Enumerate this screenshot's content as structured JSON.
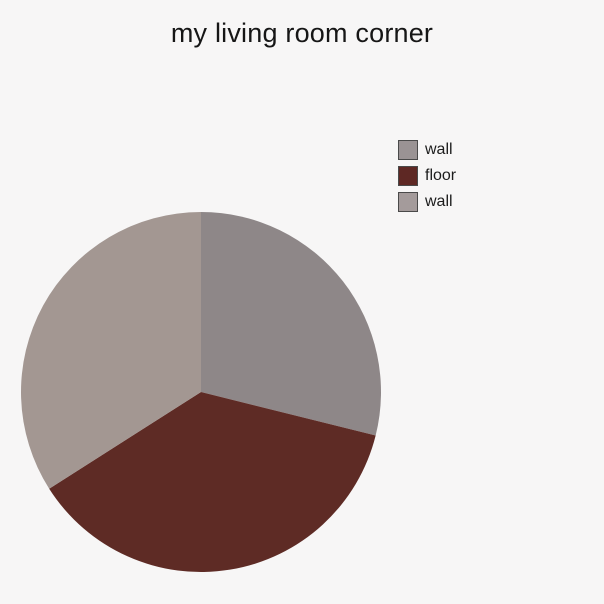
{
  "page": {
    "background_color": "#f7f6f6"
  },
  "title": {
    "text": "my living room corner",
    "color": "#161616"
  },
  "chart_data": {
    "type": "pie",
    "title": "my living room corner",
    "angle_convention": "degrees clockwise from 12 o'clock",
    "center": [
      201,
      392
    ],
    "radius": 180,
    "slices": [
      {
        "label": "wall",
        "start_deg": 0,
        "end_deg": 104,
        "angle_deg": 104,
        "percent": 28.9,
        "color": "#8e8788"
      },
      {
        "label": "floor",
        "start_deg": 104,
        "end_deg": 237.5,
        "angle_deg": 133.5,
        "percent": 37.1,
        "color": "#5e2b25"
      },
      {
        "label": "wall",
        "start_deg": 237.5,
        "end_deg": 360,
        "angle_deg": 122.5,
        "percent": 34.0,
        "color": "#a39792"
      }
    ],
    "legend": {
      "position": "right",
      "entries": [
        {
          "label": "wall",
          "swatch_color": "#9a9394",
          "border_color": "#4a4a4a"
        },
        {
          "label": "floor",
          "swatch_color": "#5e2824",
          "border_color": "#4a4a4a"
        },
        {
          "label": "wall",
          "swatch_color": "#a49b9b",
          "border_color": "#4a4a4a"
        }
      ]
    }
  }
}
